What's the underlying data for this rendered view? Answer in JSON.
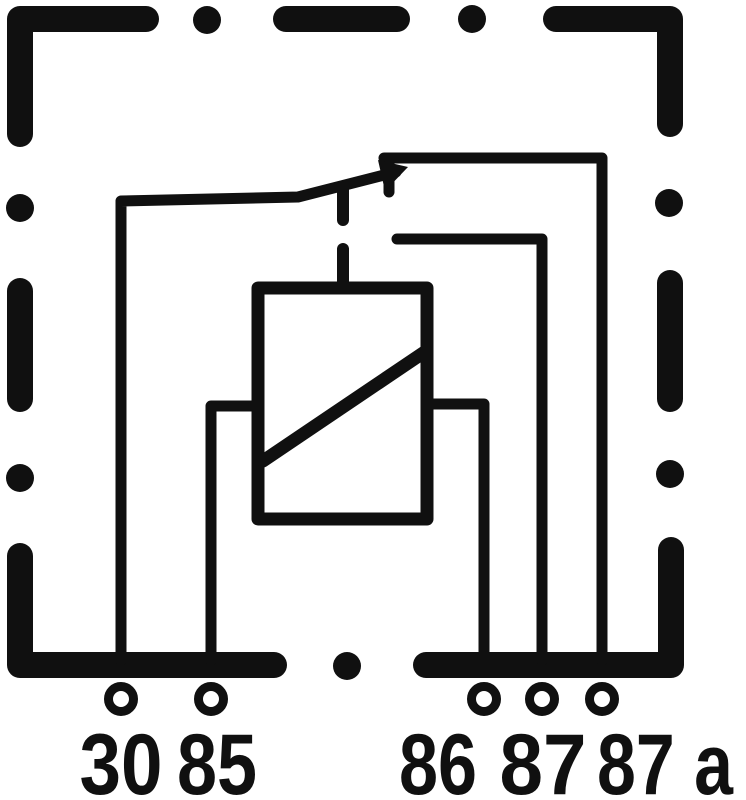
{
  "diagram": {
    "type": "relay-schematic",
    "background_color": "#ffffff",
    "stroke_color": "#101010",
    "terminals": {
      "t30": "30",
      "t85": "85",
      "t86": "86",
      "t87": "87",
      "t87a": "87 a"
    }
  }
}
